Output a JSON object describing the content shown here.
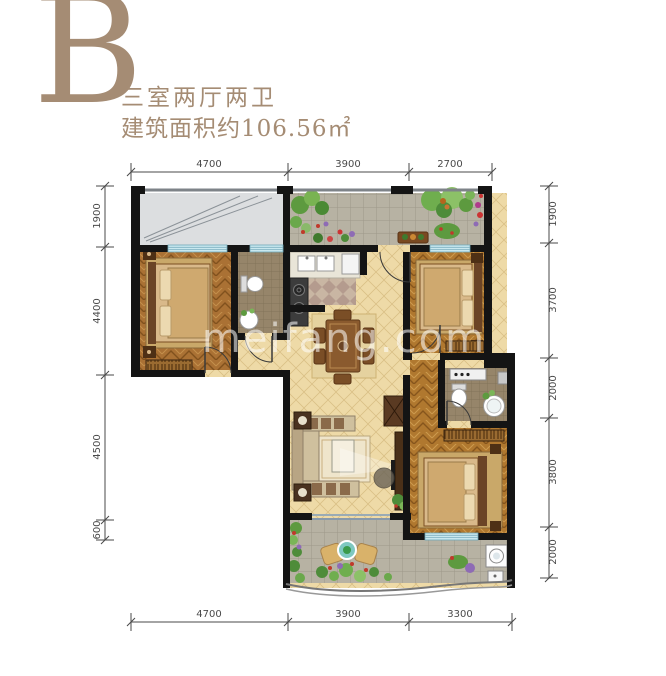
{
  "header": {
    "unit_label": "B",
    "layout_title": "三室两厅两卫",
    "area_label": "建筑面积约106.56㎡"
  },
  "watermark": "meifang.com",
  "dimensions": {
    "top": [
      "4700",
      "3900",
      "2700"
    ],
    "bottom": [
      "4700",
      "3900",
      "3300"
    ],
    "left": [
      "1900",
      "4400",
      "4500",
      "600"
    ],
    "right": [
      "1900",
      "3700",
      "2000",
      "3800",
      "2000"
    ]
  },
  "colors": {
    "accent": "#a58c74",
    "wall": "#141414",
    "wood": "#aa7134",
    "tile_cream": "#eedaa7",
    "terrace_tile": "#b7b2a3",
    "bath_tile": "#96856a",
    "window": "#c9e8ef",
    "dimension_line": "#4a4a4a"
  }
}
